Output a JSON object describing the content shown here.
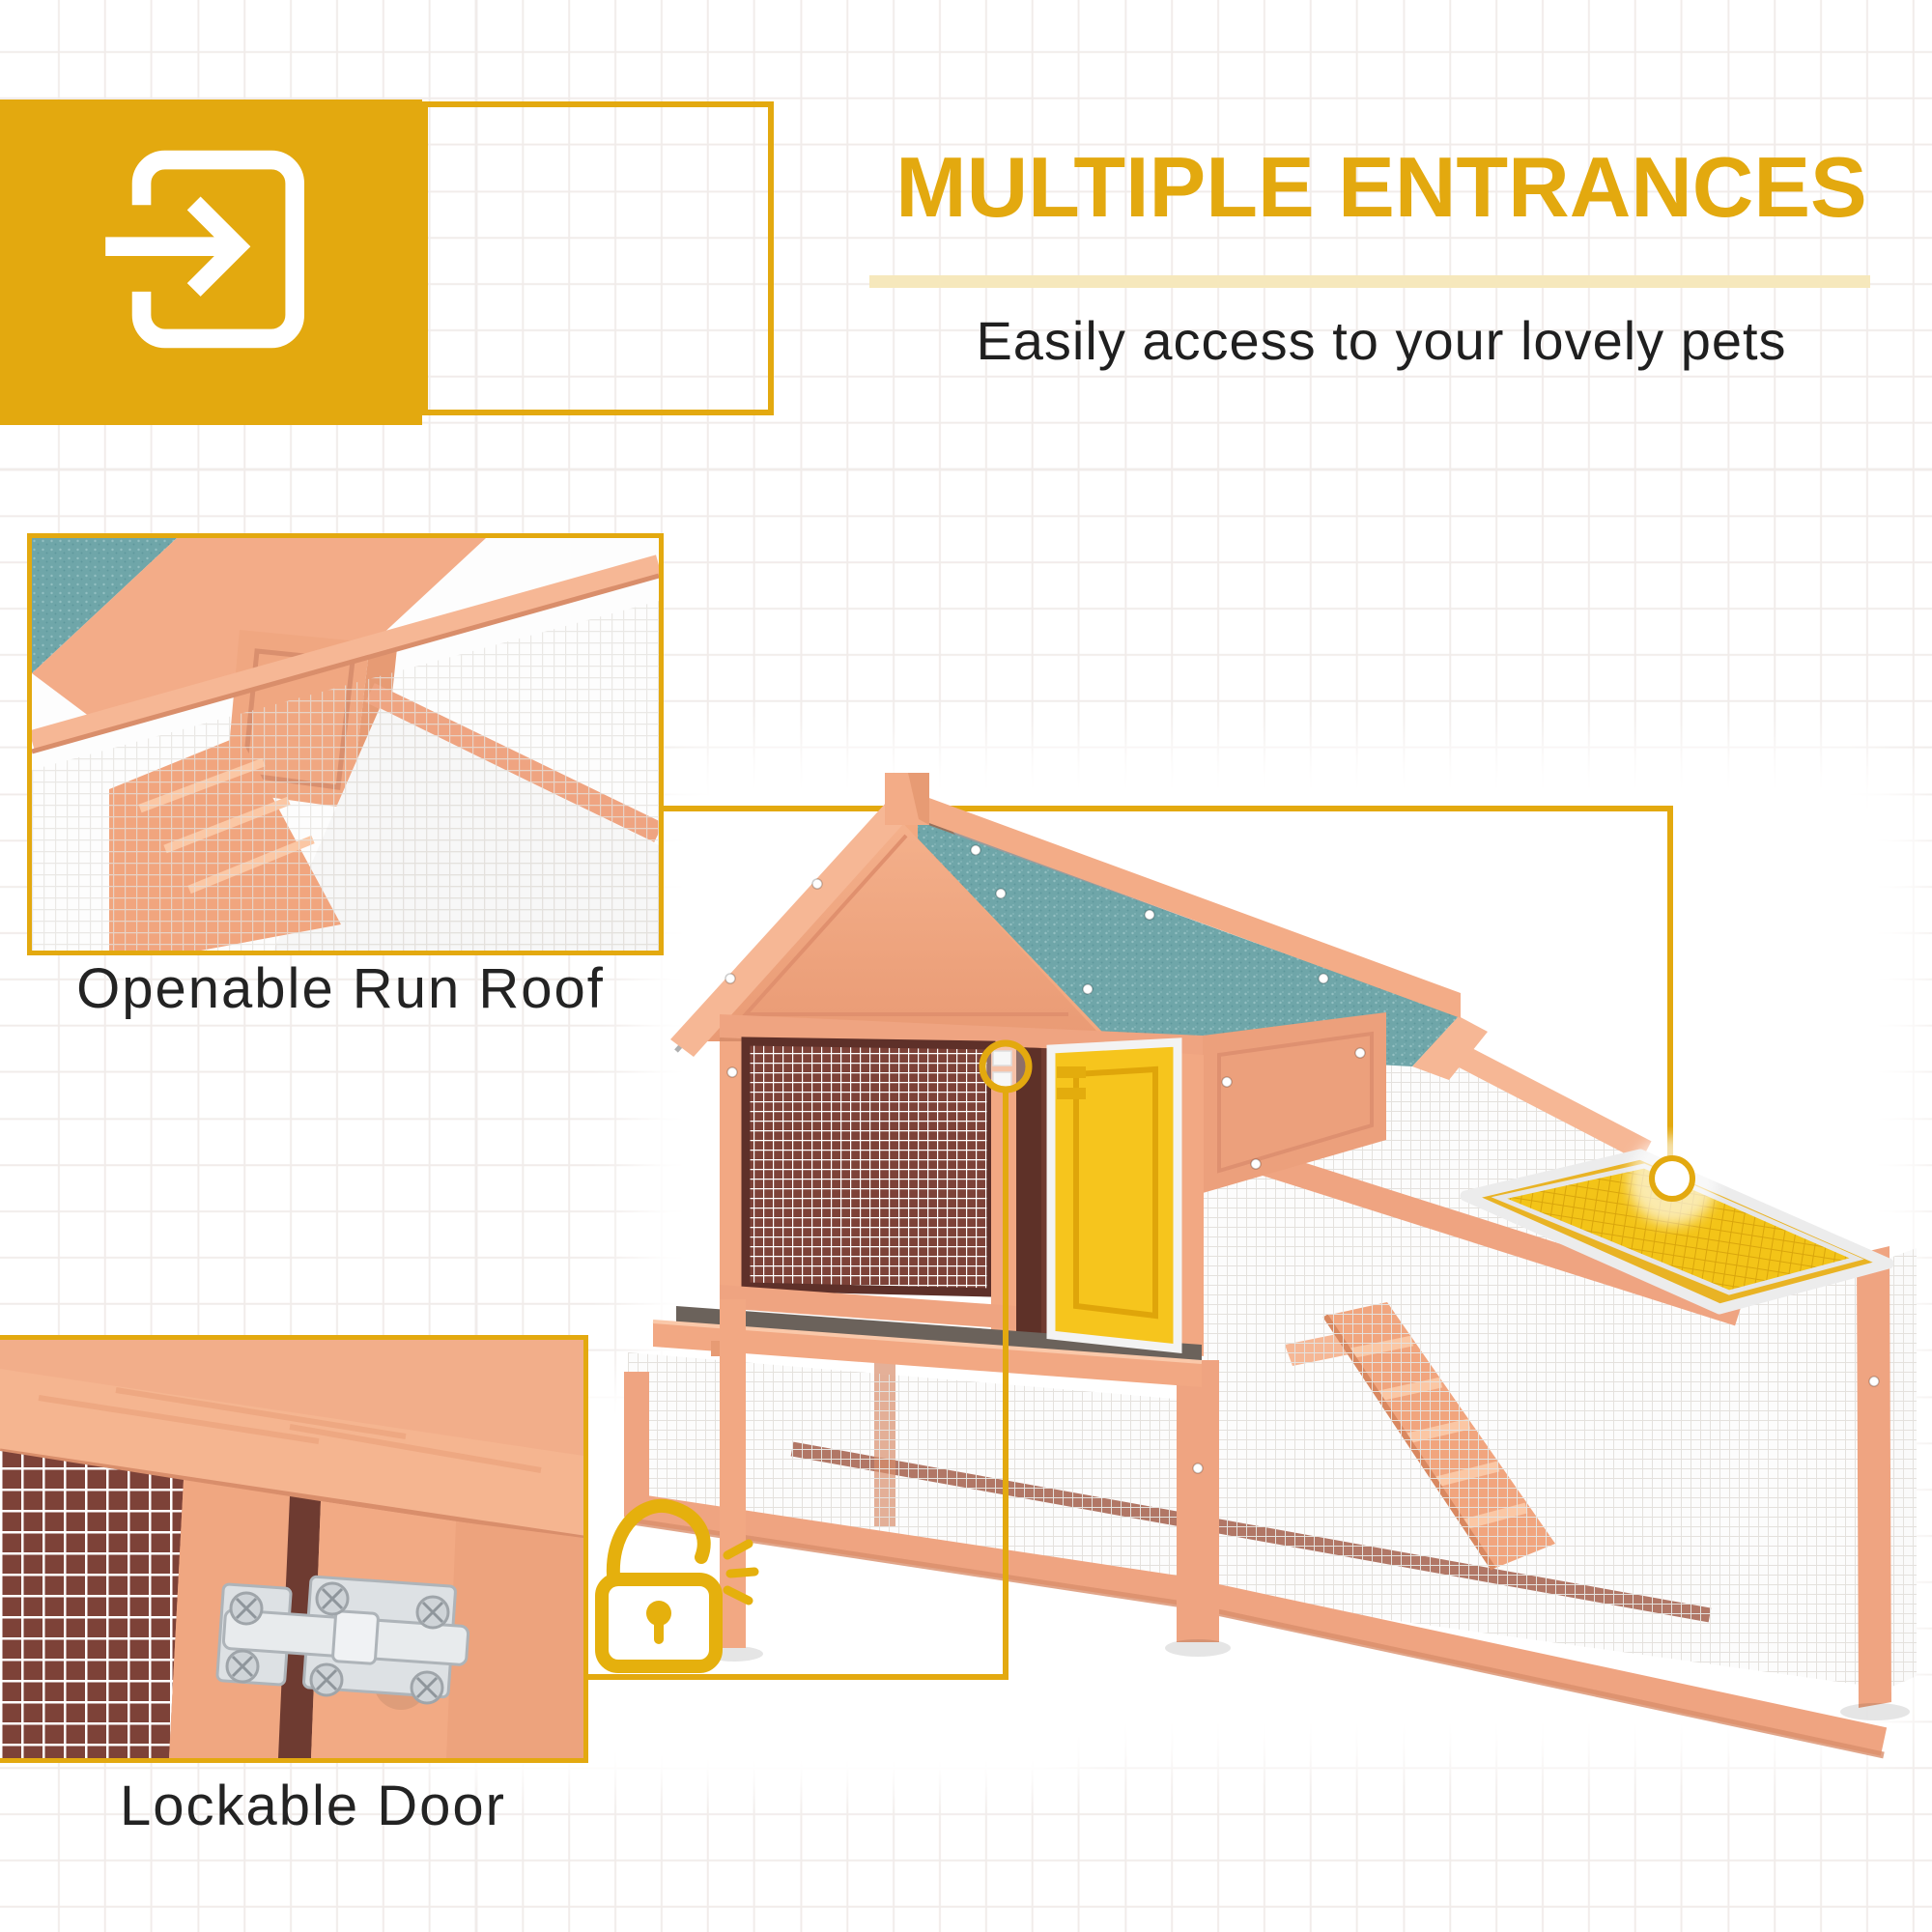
{
  "header": {
    "title": "MULTIPLE ENTRANCES",
    "subtitle": "Easily access to your lovely pets",
    "icon": "enter-arrow-icon"
  },
  "callouts": {
    "run_roof": {
      "label": "Openable Run Roof",
      "marker": "circle-marker-icon"
    },
    "door": {
      "label": "Lockable Door",
      "marker": "padlock-unlocked-icon"
    }
  },
  "product": {
    "description": "wooden chicken coop hutch with teal asphalt gable roof, wire mesh panels, open yellow access door, sliding cleaning tray, climbing ramp and yellow openable mesh run roof"
  },
  "theme": {
    "gold": "#E3A90F",
    "gold-soft": "#F6E8BC",
    "text-dark": "#1F1F1F",
    "wood": "#EFA481",
    "wood-light": "#F6B795",
    "wood-dark": "#DE8E6C",
    "wood-deep": "#B96A50",
    "interior": "#6F3B31",
    "interior-panel": "#7D4238",
    "teal": "#6FA6A9",
    "door-yellow": "#F6C51D",
    "roof-yellow": "#F3C418",
    "roof-margin": "#E9B324",
    "mesh-line": "#E4E1DD",
    "tray-gray": "#6B625B",
    "metal": "#D8DCDF",
    "grid-line": "#F1ECEA"
  }
}
